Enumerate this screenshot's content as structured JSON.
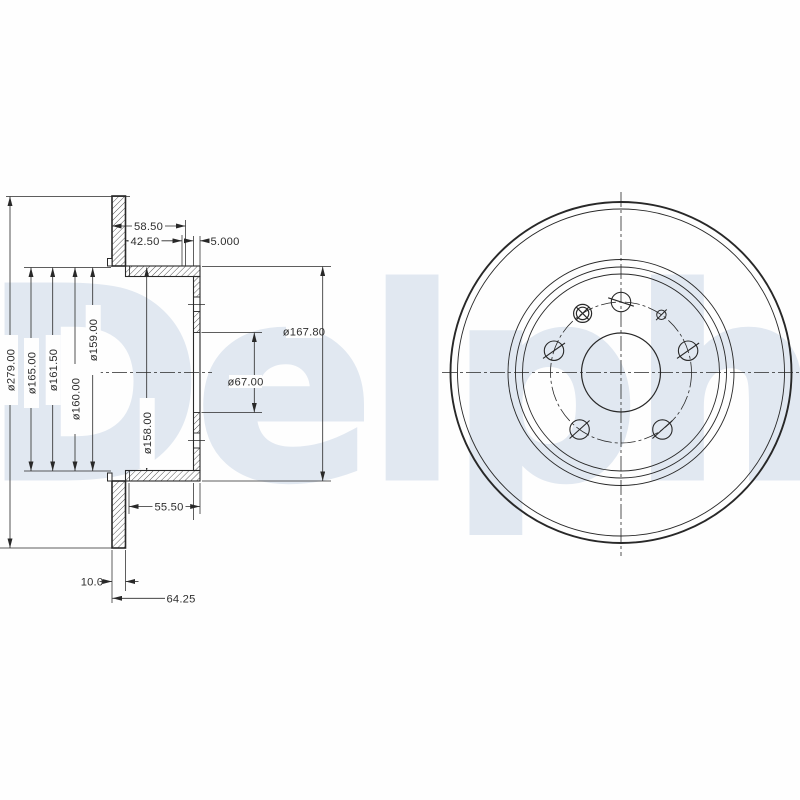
{
  "watermark": {
    "text": "Delphi",
    "color": "#e1e8f1"
  },
  "drawing": {
    "line_color": "#282828",
    "part": "brake-disc-technical-drawing",
    "section_view_labels": {
      "d279": "ø279.00",
      "d165": "ø165.00",
      "d161_5": "ø161.50",
      "d160": "ø160.00",
      "d159": "ø159.00",
      "d158": "ø158.00",
      "d167_8": "ø167.80",
      "d67": "ø67.00",
      "w58_5": "58.50",
      "w42_5": "42.50",
      "w5": "5.000",
      "w55_5": "55.50",
      "t10": "10.0",
      "h64_25": "64.25"
    },
    "front_view": {
      "bolt_holes": 5,
      "threaded_hole": 1,
      "pin_hole": 1
    }
  }
}
